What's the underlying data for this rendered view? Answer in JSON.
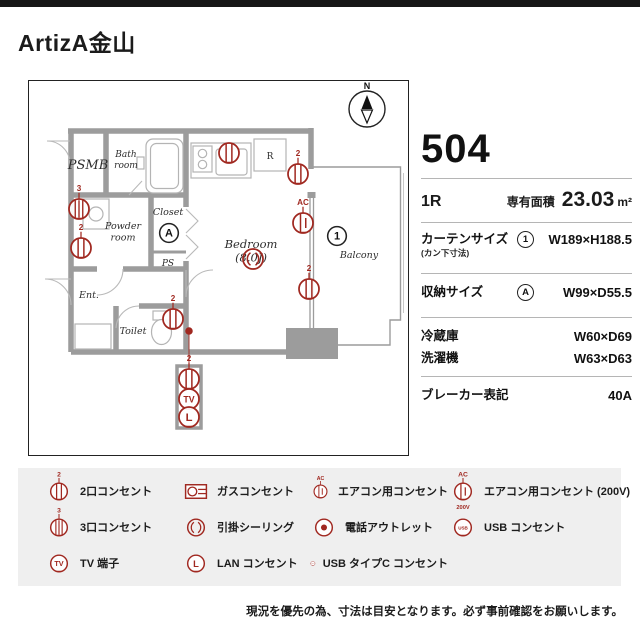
{
  "page": {
    "title": "ArtizA金山",
    "note": "現況を優先の為、寸法は目安となります。必ず事前確認をお願いします。"
  },
  "info": {
    "room_number": "504",
    "layout_type": "1R",
    "area_label": "専有面積",
    "area_value": "23.03",
    "area_unit": "m²",
    "rows": [
      {
        "label": "カーテンサイズ",
        "sublabel": "(カン下寸法)",
        "marker": "1",
        "value": "W189×H188.5"
      },
      {
        "label": "収納サイズ",
        "marker": "A",
        "value": "W99×D55.5"
      },
      {
        "label": "冷蔵庫",
        "value": "W60×D69"
      },
      {
        "label": "洗濯機",
        "value": "W63×D63"
      },
      {
        "label": "ブレーカー表記",
        "value": "40A"
      }
    ]
  },
  "floor_plan": {
    "compass_label": "N",
    "accent_color": "#a02820",
    "rooms": [
      {
        "lines": [
          "PSMB"
        ],
        "x": 59,
        "y": 88,
        "size": 13,
        "italic": true
      },
      {
        "lines": [
          "Bath",
          "room"
        ],
        "x": 97,
        "y": 76,
        "size": 9,
        "italic": true
      },
      {
        "lines": [
          "Powder",
          "room"
        ],
        "x": 94,
        "y": 148,
        "size": 9.5,
        "italic": true
      },
      {
        "lines": [
          "Closet"
        ],
        "x": 139,
        "y": 134,
        "size": 9.5,
        "italic": true
      },
      {
        "lines": [
          "PS"
        ],
        "x": 139,
        "y": 185,
        "size": 9,
        "italic": true
      },
      {
        "lines": [
          "Bedroom",
          "(8.0J)"
        ],
        "x": 222,
        "y": 167,
        "size": 11.5,
        "italic": true
      },
      {
        "lines": [
          "Balcony"
        ],
        "x": 330,
        "y": 177,
        "size": 9.5,
        "italic": true
      },
      {
        "lines": [
          "Ent."
        ],
        "x": 60,
        "y": 217,
        "size": 9.5,
        "italic": true
      },
      {
        "lines": [
          "Toilet"
        ],
        "x": 104,
        "y": 253,
        "size": 9.5,
        "italic": true
      },
      {
        "lines": [
          "R"
        ],
        "x": 241,
        "y": 78,
        "size": 9,
        "italic": false
      }
    ],
    "symbols": [
      {
        "type": "outlet",
        "badge": "",
        "x": 200,
        "y": 72
      },
      {
        "type": "outlet",
        "badge": "2",
        "x": 269,
        "y": 93
      },
      {
        "type": "outlet3",
        "badge": "3",
        "x": 50,
        "y": 128
      },
      {
        "type": "outlet",
        "badge": "2",
        "x": 52,
        "y": 167
      },
      {
        "type": "ac",
        "badge": "AC",
        "x": 274,
        "y": 142
      },
      {
        "type": "ceiling",
        "x": 224,
        "y": 178
      },
      {
        "type": "outlet",
        "badge": "2",
        "x": 280,
        "y": 208
      },
      {
        "type": "outlet",
        "badge": "2",
        "x": 144,
        "y": 238
      },
      {
        "type": "phone-dot",
        "x": 160,
        "y": 250
      },
      {
        "type": "outlet",
        "badge": "2",
        "x": 160,
        "y": 298
      },
      {
        "type": "tv",
        "text": "TV",
        "x": 160,
        "y": 318
      },
      {
        "type": "lan",
        "text": "L",
        "x": 160,
        "y": 336
      }
    ],
    "markers": [
      {
        "label": "1",
        "x": 308,
        "y": 155
      },
      {
        "label": "A",
        "x": 140,
        "y": 152
      }
    ]
  },
  "legend": {
    "items": [
      {
        "type": "outlet",
        "badge": "2",
        "label": "2口コンセント"
      },
      {
        "type": "gas",
        "label": "ガスコンセント"
      },
      {
        "type": "ac",
        "badge": "AC",
        "label": "エアコン用コンセント"
      },
      {
        "type": "ac200",
        "badge": "AC",
        "text": "200V",
        "label": "エアコン用コンセント (200V)"
      },
      {
        "type": "outlet3",
        "badge": "3",
        "label": "3口コンセント"
      },
      {
        "type": "ceiling",
        "label": "引掛シーリング"
      },
      {
        "type": "phone",
        "label": "電話アウトレット"
      },
      {
        "type": "usb",
        "text": "USB",
        "label": "USB コンセント"
      },
      {
        "type": "tv",
        "text": "TV",
        "label": "TV 端子"
      },
      {
        "type": "lan",
        "text": "L",
        "label": "LAN コンセント"
      },
      {
        "type": "usbc",
        "text": "USB-C",
        "label": "USB タイプC コンセント"
      }
    ]
  }
}
